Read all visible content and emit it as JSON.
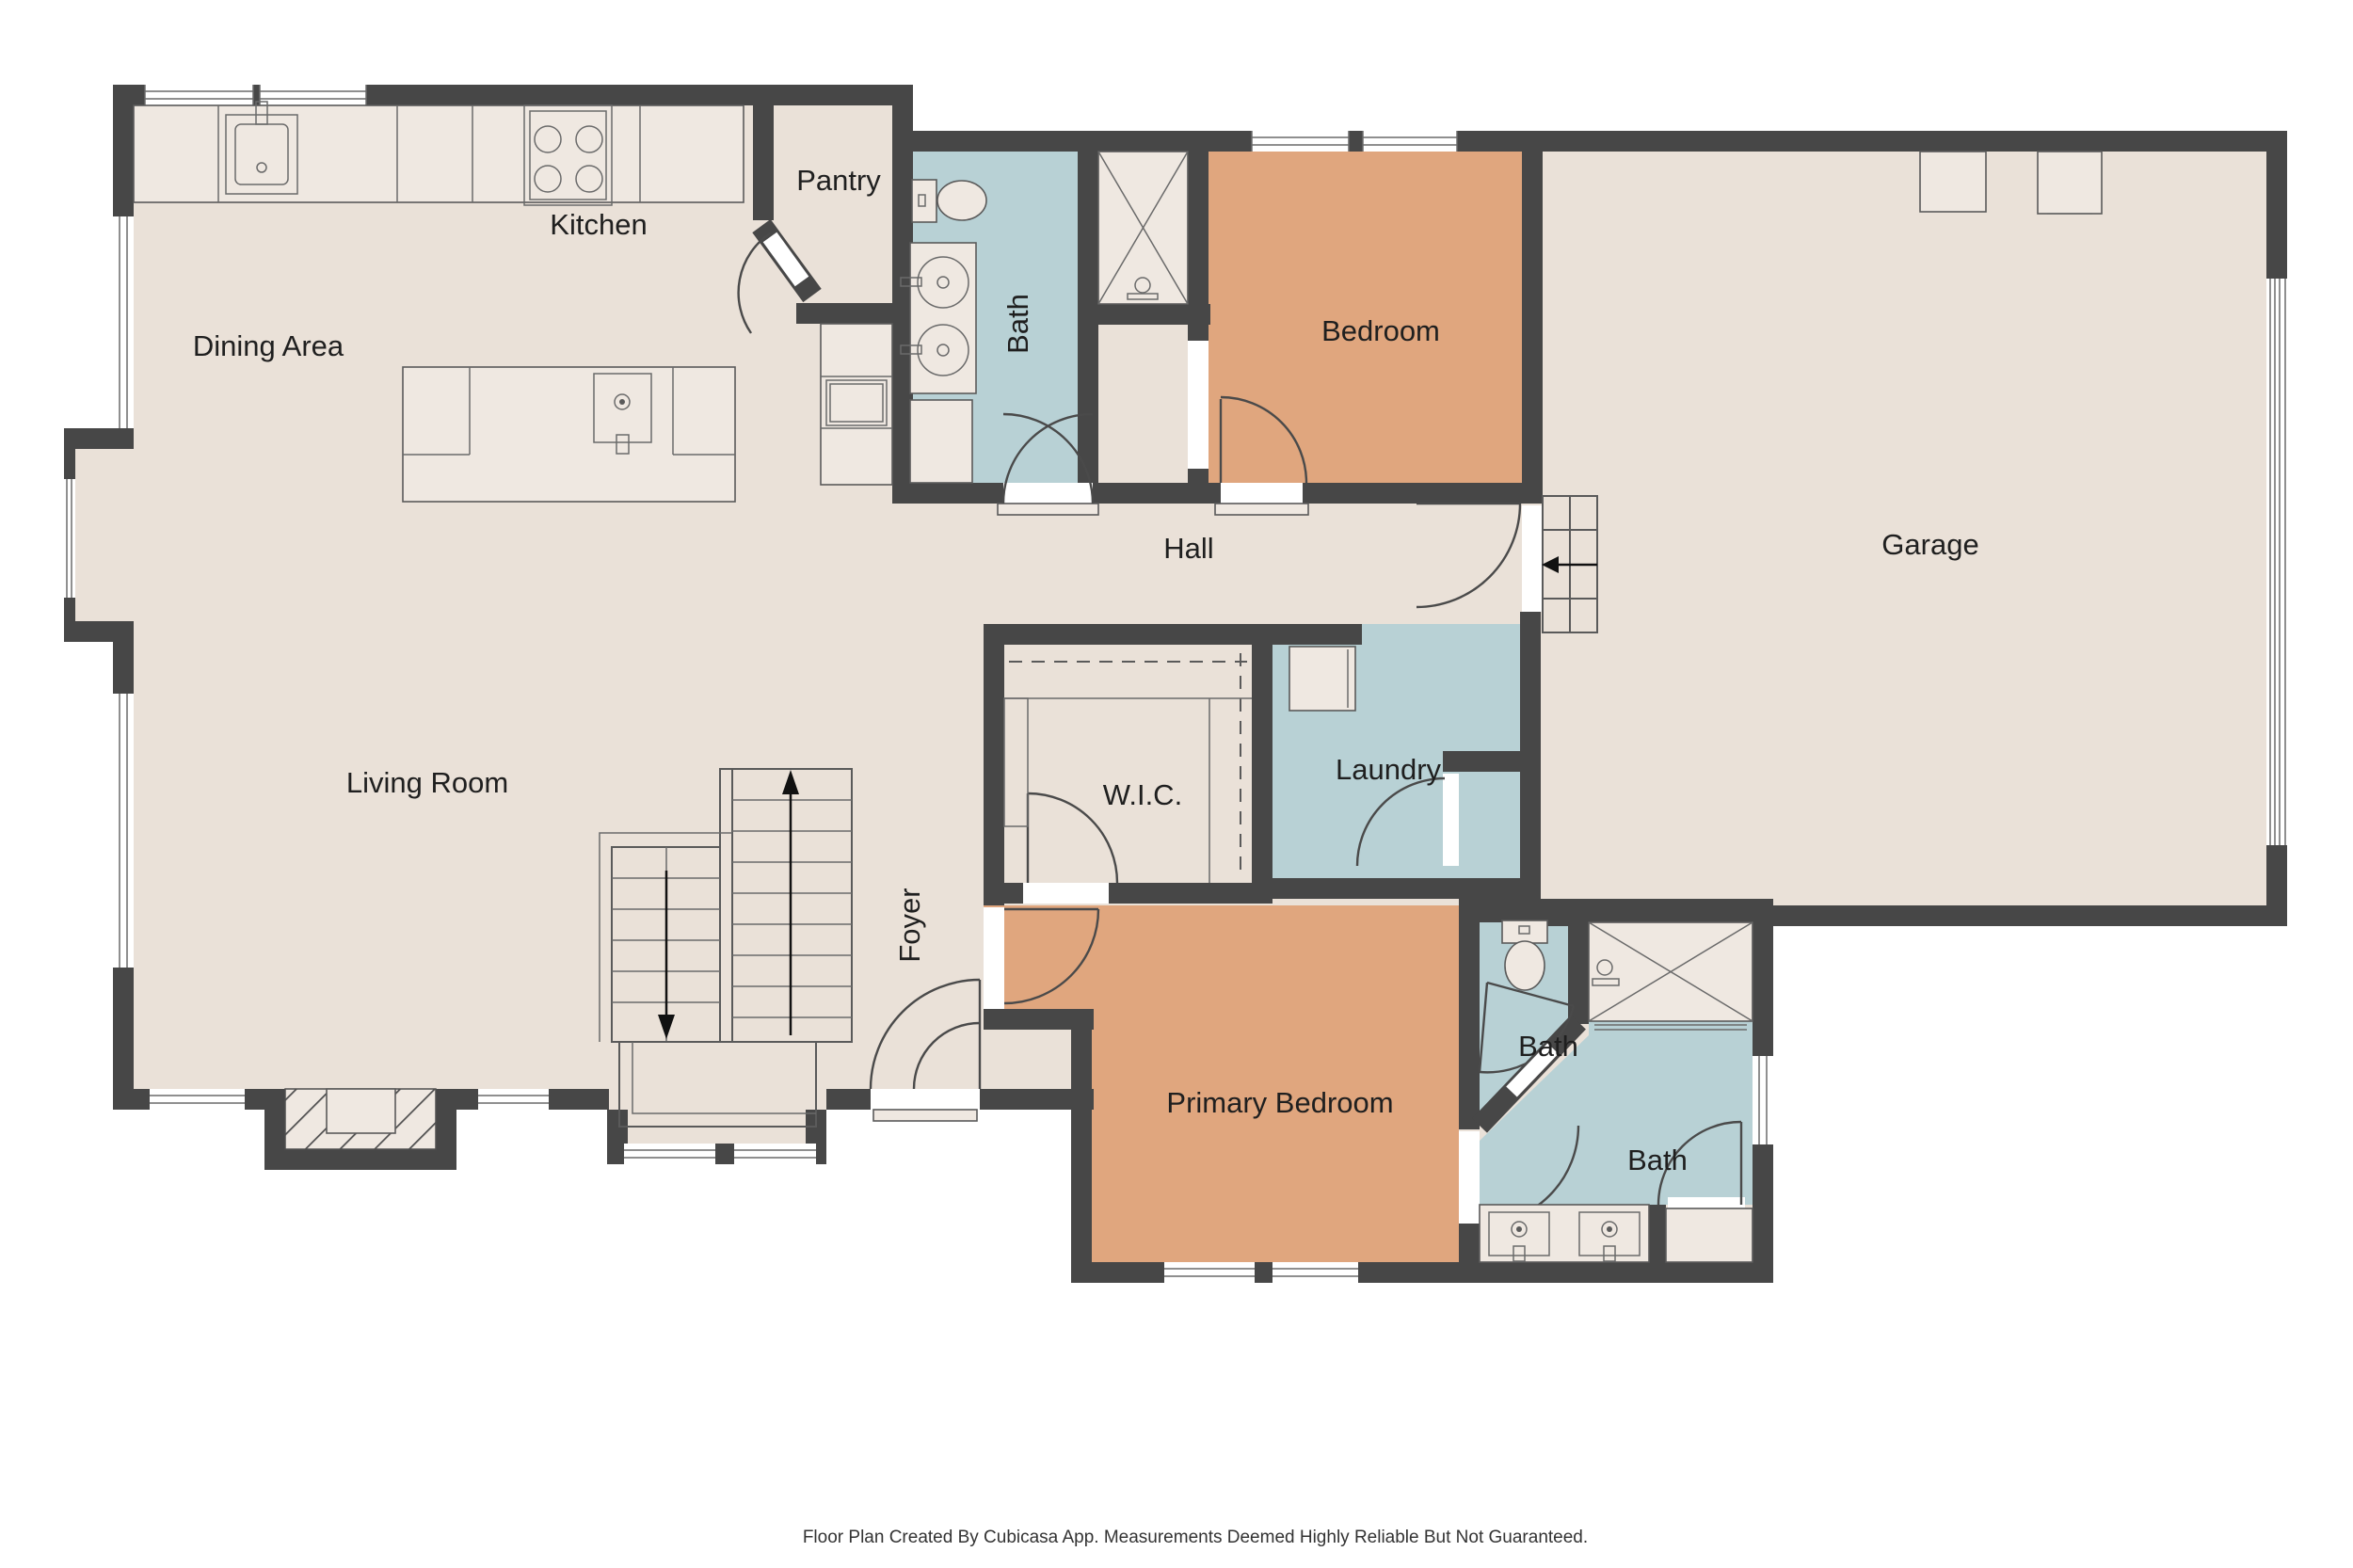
{
  "footer": {
    "text": "Floor Plan Created By Cubicasa App. Measurements Deemed Highly Reliable But Not Guaranteed."
  },
  "palette": {
    "wall": "#474747",
    "floor": "#EAE1D8",
    "fixture": "#EFE8E1",
    "room_blue": "#B8D1D5",
    "room_orange": "#E0A67E",
    "line": "#5A5A5A",
    "label": "#1F1F1F",
    "background": "#FFFFFF"
  },
  "rooms": [
    {
      "id": "kitchen",
      "label": "Kitchen"
    },
    {
      "id": "dining-area",
      "label": "Dining Area"
    },
    {
      "id": "pantry",
      "label": "Pantry"
    },
    {
      "id": "bath-top",
      "label": "Bath"
    },
    {
      "id": "bedroom",
      "label": "Bedroom"
    },
    {
      "id": "garage",
      "label": "Garage"
    },
    {
      "id": "hall",
      "label": "Hall"
    },
    {
      "id": "laundry",
      "label": "Laundry"
    },
    {
      "id": "wic",
      "label": "W.I.C."
    },
    {
      "id": "living-room",
      "label": "Living Room"
    },
    {
      "id": "foyer",
      "label": "Foyer"
    },
    {
      "id": "primary-bedroom",
      "label": "Primary Bedroom"
    },
    {
      "id": "bath-primary-wc",
      "label": "Bath"
    },
    {
      "id": "bath-primary",
      "label": "Bath"
    }
  ],
  "icons": {
    "stairs_up": "up-arrow",
    "stairs_down": "down-arrow",
    "garage_step": "left-arrow"
  }
}
